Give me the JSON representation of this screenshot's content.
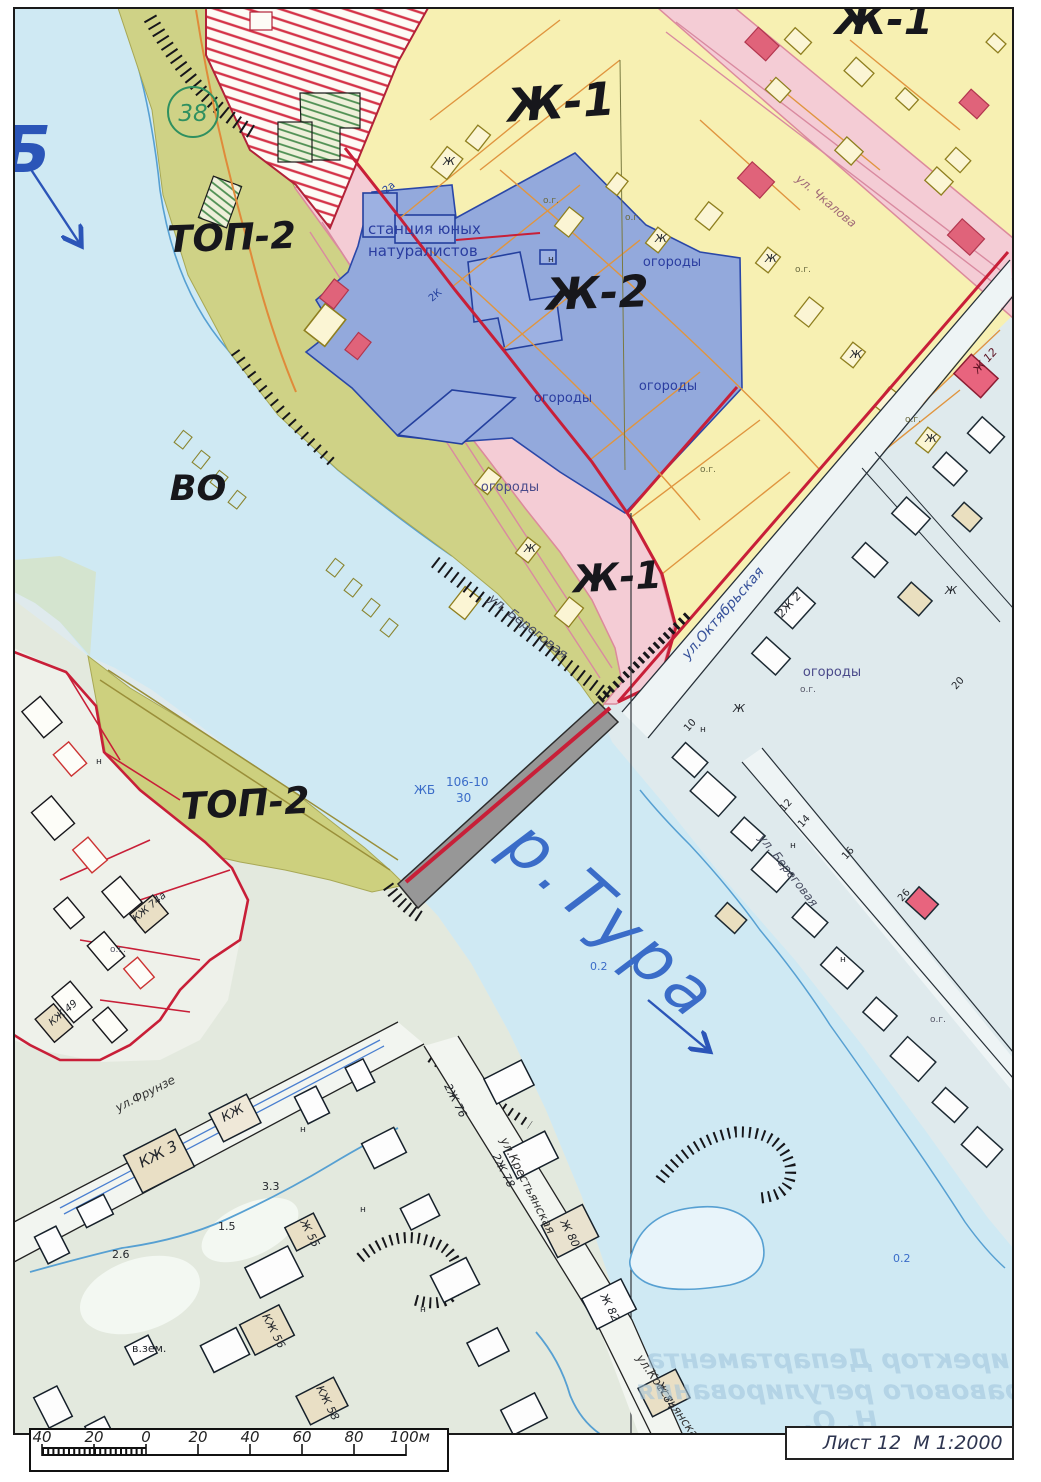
{
  "sheet": {
    "label": "Лист 12",
    "scale": "М 1:2000"
  },
  "scale_bar": {
    "ticks": [
      "40",
      "20",
      "0",
      "20",
      "40",
      "60",
      "80",
      "100м"
    ]
  },
  "zones": {
    "zh1": "Ж-1",
    "zh2": "Ж-2",
    "top2": "ТОП-2",
    "vo": "ВО",
    "circle": "38",
    "edge_letter": "Б"
  },
  "river": {
    "name": "р.Тура",
    "depth": "0.2"
  },
  "bridge": {
    "material": "ЖБ",
    "size": "106-10",
    "capacity": "30"
  },
  "station": {
    "line1": "станция юных",
    "line2": "натуралистов"
  },
  "land": {
    "gardens": "огороды",
    "og": "о.г.",
    "n": "н",
    "zh": "Ж"
  },
  "streets": {
    "beregovaya": "ул. Береговая",
    "oktyabrskaya": "ул.Октябрьская",
    "chkalova": "ул. Чкалова",
    "frunze": "ул.Фрунзе",
    "krestyanskaya": "ул.Крестьянская"
  },
  "buildings": {
    "zh12": "Ж 12",
    "zh2_2": "2Ж 2",
    "zh2_76": "2Ж 76",
    "zh2_78": "2Ж 78",
    "zh80": "Ж 80",
    "zh82": "Ж 82",
    "zh84": "Ж 84",
    "zh55": "Ж 55",
    "kzh": "КЖ",
    "kzh3": "КЖ 3",
    "kzh56": "КЖ 56",
    "kzh58": "КЖ 58",
    "kzh74a": "КЖ 74а",
    "kzh49": "КЖ 49",
    "k2": "2К",
    "n2a": "2а"
  },
  "numbers": {
    "n10": "10",
    "n12": "12",
    "n14": "14",
    "n16": "16",
    "n20": "20",
    "n26": "26",
    "n33": "3.3",
    "n15": "1.5",
    "n26b": "2.6",
    "vzem": "в.зем."
  },
  "stamp": {
    "line1": "Директор Департамента",
    "line2": "правового регулирования",
    "line3": "Н. О."
  }
}
